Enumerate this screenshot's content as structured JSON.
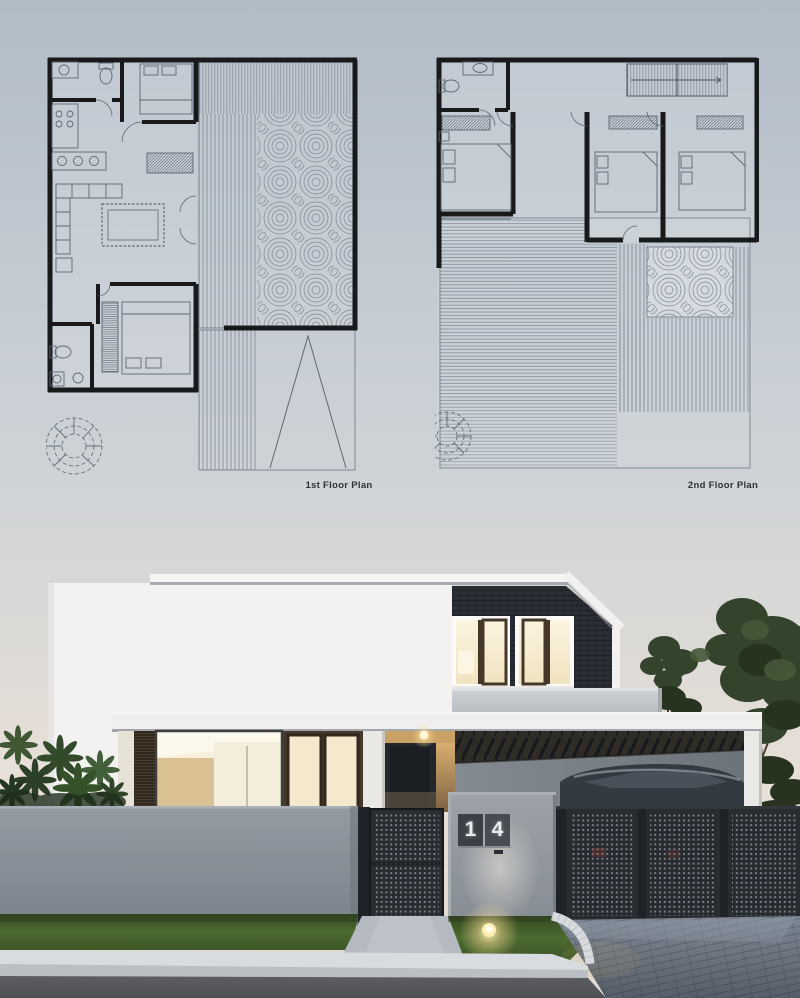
{
  "presentation": {
    "plans": {
      "first_label": "1st Floor Plan",
      "second_label": "2nd Floor Plan"
    },
    "house": {
      "number": "14",
      "digits": [
        "1",
        "4"
      ]
    },
    "colors": {
      "sky_top": "#b2bcc7",
      "sky_horizon": "#e9e1d8",
      "plan_wall": "#17191b",
      "plan_thin_line": "#5d6873",
      "plan_hatch": "#7f8a96",
      "house_white": "#f3f2f0",
      "dark_cladding": "#282d33",
      "window_glow": "#f8f0da",
      "wood_frame": "#46382a",
      "wood_wall": "#c9a164",
      "balcony_parapet": "#c0c4c8",
      "fence_gray": "#868d94",
      "gate_metal": "#282c31",
      "number_plate": "#3b4046",
      "grass_green": "#45622c",
      "walkway_concrete": "#b4bac0",
      "curb_white": "#d7dade",
      "paver_gray": "#7e8894",
      "road_asphalt": "#56585c",
      "warm_light": "#ffe098",
      "foliage_green": "#34432c"
    }
  }
}
